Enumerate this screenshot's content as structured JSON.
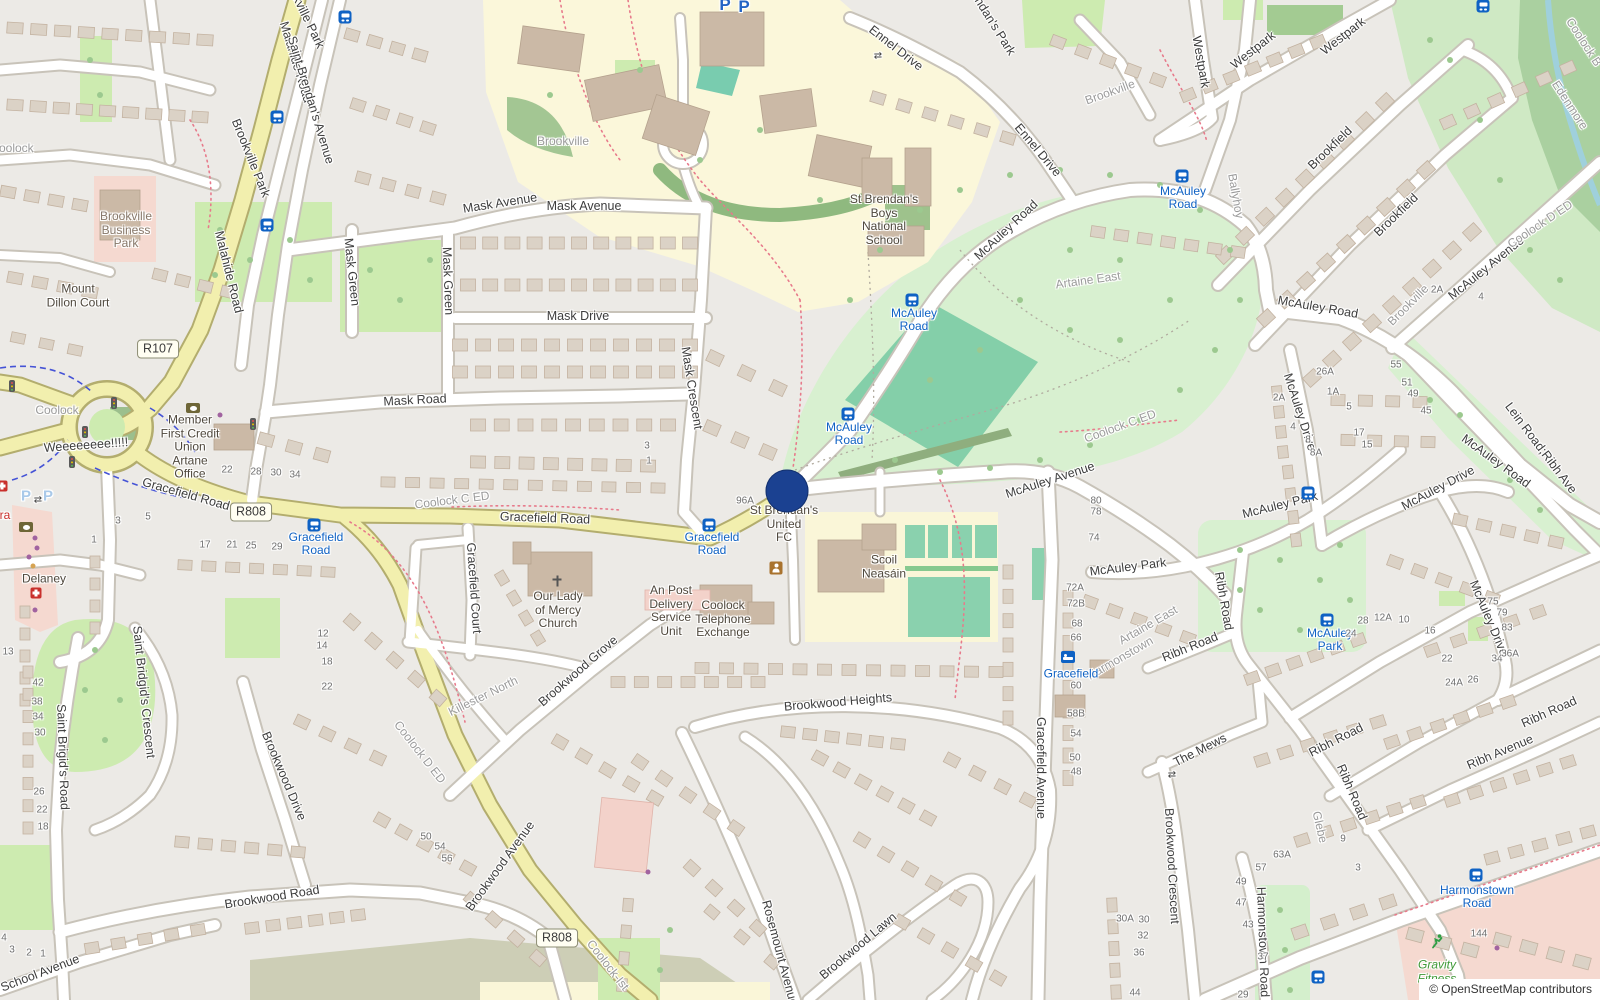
{
  "attribution": "© OpenStreetMap contributors",
  "map": {
    "marker": {
      "x": 787,
      "y": 491
    },
    "route_shields": [
      {
        "text": "R107",
        "x": 158,
        "y": 349
      },
      {
        "text": "R808",
        "x": 251,
        "y": 512
      },
      {
        "text": "R808",
        "x": 557,
        "y": 938
      }
    ],
    "street_labels": [
      [
        "Malahide Road",
        296,
        62,
        73
      ],
      [
        "Malahide Road",
        229,
        272,
        76
      ],
      [
        "Saint Brendan's Avenue",
        311,
        100,
        73
      ],
      [
        "Brookville Park",
        251,
        158,
        68
      ],
      [
        "Brookville Park",
        303,
        10,
        64
      ],
      [
        "Mask Avenue",
        500,
        203,
        -9
      ],
      [
        "Mask Avenue",
        584,
        206,
        0
      ],
      [
        "Mask Green",
        352,
        272,
        84
      ],
      [
        "Mask Green",
        448,
        281,
        88
      ],
      [
        "Mask Drive",
        578,
        316,
        0
      ],
      [
        "Mask Road",
        415,
        400,
        -3
      ],
      [
        "Mask Crescent",
        692,
        388,
        81
      ],
      [
        "Gracefield Road",
        186,
        494,
        16
      ],
      [
        "Gracefield Road",
        545,
        518,
        2
      ],
      [
        "Gracefield Court",
        474,
        588,
        86
      ],
      [
        "Gracefield Avenue",
        1041,
        768,
        90
      ],
      [
        "Ennel Drive",
        896,
        48,
        38
      ],
      [
        "Ennel Drive",
        1038,
        150,
        50
      ],
      [
        "Brendan's Park",
        990,
        18,
        58
      ],
      [
        "Westpark",
        1201,
        62,
        80
      ],
      [
        "Westpark",
        1253,
        50,
        -38
      ],
      [
        "Westpark",
        1343,
        36,
        -38
      ],
      [
        "Brookfield",
        1330,
        148,
        -44
      ],
      [
        "Brookfield",
        1396,
        215,
        -44
      ],
      [
        "McAuley Road",
        1006,
        230,
        -43
      ],
      [
        "McAuley Road",
        1318,
        307,
        10
      ],
      [
        "McAuley Road",
        1496,
        461,
        36
      ],
      [
        "McAuley Avenue",
        1050,
        480,
        -18
      ],
      [
        "McAuley Avenue",
        1486,
        268,
        -39
      ],
      [
        "McAuley Park",
        1128,
        567,
        -7
      ],
      [
        "McAuley Park",
        1280,
        505,
        -14
      ],
      [
        "McAuley Drive",
        1300,
        412,
        72
      ],
      [
        "McAuley Drive",
        1438,
        488,
        -28
      ],
      [
        "McAuley Drive",
        1489,
        618,
        67
      ],
      [
        "Lein Road;Ribh Ave",
        1541,
        448,
        53
      ],
      [
        "Ribh Avenue",
        1500,
        752,
        -23
      ],
      [
        "Ribh Road",
        1190,
        647,
        -22
      ],
      [
        "Ribh Road",
        1224,
        601,
        80
      ],
      [
        "Ribh Road",
        1336,
        740,
        -27
      ],
      [
        "Ribh Road",
        1352,
        792,
        67
      ],
      [
        "Ribh Road",
        1549,
        712,
        -24
      ],
      [
        "The Mews",
        1200,
        750,
        -27
      ],
      [
        "Brookwood Crescent",
        1172,
        866,
        87
      ],
      [
        "Brookwood Grove",
        578,
        671,
        -41
      ],
      [
        "Brookwood Heights",
        838,
        702,
        -5
      ],
      [
        "Brookwood Road",
        272,
        897,
        -9
      ],
      [
        "Brookwood Avenue",
        500,
        866,
        -54
      ],
      [
        "Brookwood Drive",
        284,
        776,
        67
      ],
      [
        "Brookwood Lawn",
        858,
        946,
        -40
      ],
      [
        "Rosemount Avenue",
        780,
        953,
        75
      ],
      [
        "Harmonstown Road",
        1263,
        942,
        88
      ],
      [
        "Saint Bridgid's Crescent",
        144,
        692,
        84
      ],
      [
        "Saint Brigid's Road",
        63,
        757,
        88
      ],
      [
        "School Avenue",
        40,
        973,
        -21
      ],
      [
        "Weeeeeeee!!!!!",
        86,
        445,
        -4
      ]
    ],
    "locality_labels": [
      [
        "Coolock",
        57,
        410,
        0
      ],
      [
        "Coolock",
        12,
        148,
        0
      ],
      [
        "Brookville",
        563,
        141,
        0
      ],
      [
        "Brookville",
        1110,
        92,
        -20
      ],
      [
        "Brookville",
        1408,
        305,
        -45
      ],
      [
        "Ballyhoy",
        1236,
        196,
        80
      ],
      [
        "Artaine East",
        1088,
        280,
        -8
      ],
      [
        "Artaine East",
        1148,
        625,
        -30
      ],
      [
        "Harmonstown",
        1120,
        658,
        -30
      ],
      [
        "Killester North",
        483,
        696,
        -26
      ],
      [
        "Edenmore",
        1570,
        105,
        57
      ],
      [
        "Coolock B",
        1584,
        42,
        57
      ],
      [
        "Glebe",
        1320,
        827,
        77
      ],
      [
        "Coolock D ED",
        1540,
        224,
        -34
      ],
      [
        "Coolock D ED",
        420,
        752,
        52
      ],
      [
        "Coolock C ED",
        1120,
        426,
        -20
      ],
      [
        "Coolock C ED",
        452,
        500,
        -7
      ],
      [
        "Coolock-Ist",
        608,
        965,
        52
      ]
    ],
    "poi_labels": [
      {
        "lines": [
          "Brookville",
          "Business",
          "Park"
        ],
        "x": 126,
        "y": 230,
        "style": "biz"
      },
      {
        "lines": [
          "Mount",
          "Dillon Court"
        ],
        "x": 78,
        "y": 296,
        "style": "poi"
      },
      {
        "lines": [
          "Member",
          "First Credit",
          "Union",
          "Artane",
          "Office"
        ],
        "x": 190,
        "y": 447,
        "style": "poi"
      },
      {
        "lines": [
          "Our Lady",
          "of Mercy",
          "Church"
        ],
        "x": 558,
        "y": 610,
        "style": "poi"
      },
      {
        "lines": [
          "An Post",
          "Delivery",
          "Service",
          "Unit"
        ],
        "x": 671,
        "y": 611,
        "style": "poi"
      },
      {
        "lines": [
          "Coolock",
          "Telephone",
          "Exchange"
        ],
        "x": 723,
        "y": 619,
        "style": "poi"
      },
      {
        "lines": [
          "St Brendan's",
          "Boys",
          "National",
          "School"
        ],
        "x": 884,
        "y": 220,
        "style": "poi"
      },
      {
        "lines": [
          "Scoil",
          "Neasáin"
        ],
        "x": 884,
        "y": 567,
        "style": "poi"
      },
      {
        "lines": [
          "St Brendan's",
          "United",
          "FC"
        ],
        "x": 784,
        "y": 524,
        "style": "poi"
      },
      {
        "lines": [
          "Delaney"
        ],
        "x": 44,
        "y": 579,
        "style": "poi"
      },
      {
        "lines": [
          "Gravity",
          "Fitness"
        ],
        "x": 1437,
        "y": 972,
        "style": "fitness"
      }
    ],
    "transit_stops": [
      {
        "lines": [
          "McAuley",
          "Road"
        ],
        "x": 1183,
        "y": 198,
        "ix": 1182,
        "iy": 176,
        "icon": "bus"
      },
      {
        "lines": [
          "McAuley",
          "Road"
        ],
        "x": 914,
        "y": 320,
        "ix": 912,
        "iy": 300,
        "icon": "bus"
      },
      {
        "lines": [
          "McAuley",
          "Road"
        ],
        "x": 849,
        "y": 434,
        "ix": 848,
        "iy": 414,
        "icon": "bus"
      },
      {
        "lines": [
          "McAuley",
          "Park"
        ],
        "x": 1330,
        "y": 640,
        "ix": 1327,
        "iy": 620,
        "icon": "bus"
      },
      {
        "lines": [
          "Gracefield",
          "Road"
        ],
        "x": 316,
        "y": 544,
        "ix": 314,
        "iy": 525,
        "icon": "bus"
      },
      {
        "lines": [
          "Gracefield",
          "Road"
        ],
        "x": 712,
        "y": 544,
        "ix": 709,
        "iy": 525,
        "icon": "bus"
      },
      {
        "lines": [
          "Harmonstown",
          "Road"
        ],
        "x": 1477,
        "y": 897,
        "ix": 1476,
        "iy": 875,
        "icon": "bus"
      },
      {
        "lines": [
          "Gracefield"
        ],
        "x": 1071,
        "y": 674,
        "ix": 1068,
        "iy": 657,
        "icon": "bed"
      }
    ],
    "transit_icons_only": [
      [
        1483,
        6
      ],
      [
        345,
        17
      ],
      [
        277,
        117
      ],
      [
        267,
        225
      ],
      [
        1308,
        493
      ],
      [
        1318,
        977
      ]
    ],
    "house_numbers": [
      [
        "22",
        227,
        470
      ],
      [
        "28",
        256,
        472
      ],
      [
        "30",
        276,
        473
      ],
      [
        "34",
        295,
        475
      ],
      [
        "1",
        94,
        540
      ],
      [
        "3",
        118,
        521
      ],
      [
        "5",
        148,
        517
      ],
      [
        "17",
        205,
        545
      ],
      [
        "21",
        232,
        545
      ],
      [
        "25",
        251,
        546
      ],
      [
        "29",
        277,
        547
      ],
      [
        "3",
        647,
        446
      ],
      [
        "1",
        649,
        461
      ],
      [
        "96A",
        745,
        501
      ],
      [
        "13",
        8,
        652
      ],
      [
        "42",
        38,
        683
      ],
      [
        "38",
        37,
        702
      ],
      [
        "34",
        38,
        717
      ],
      [
        "30",
        40,
        733
      ],
      [
        "26",
        39,
        792
      ],
      [
        "22",
        42,
        810
      ],
      [
        "18",
        43,
        827
      ],
      [
        "12",
        323,
        634
      ],
      [
        "14",
        322,
        646
      ],
      [
        "18",
        327,
        662
      ],
      [
        "22",
        327,
        687
      ],
      [
        "4",
        4,
        938
      ],
      [
        "3",
        12,
        950
      ],
      [
        "2",
        29,
        953
      ],
      [
        "1",
        43,
        954
      ],
      [
        "50",
        426,
        837
      ],
      [
        "54",
        440,
        847
      ],
      [
        "56",
        447,
        859
      ],
      [
        "72A",
        1075,
        588
      ],
      [
        "72B",
        1076,
        604
      ],
      [
        "68",
        1077,
        624
      ],
      [
        "66",
        1076,
        638
      ],
      [
        "60",
        1076,
        686
      ],
      [
        "58B",
        1076,
        714
      ],
      [
        "54",
        1076,
        734
      ],
      [
        "50",
        1075,
        758
      ],
      [
        "48",
        1076,
        772
      ],
      [
        "30A",
        1125,
        919
      ],
      [
        "30",
        1144,
        920
      ],
      [
        "32",
        1143,
        936
      ],
      [
        "36",
        1139,
        953
      ],
      [
        "44",
        1135,
        993
      ],
      [
        "28",
        1363,
        621
      ],
      [
        "12A",
        1383,
        618
      ],
      [
        "10",
        1404,
        620
      ],
      [
        "24",
        1351,
        634
      ],
      [
        "16",
        1430,
        631
      ],
      [
        "22",
        1447,
        659
      ],
      [
        "24A",
        1454,
        683
      ],
      [
        "26",
        1473,
        680
      ],
      [
        "34",
        1497,
        659
      ],
      [
        "36A",
        1510,
        654
      ],
      [
        "75",
        1493,
        602
      ],
      [
        "79",
        1502,
        613
      ],
      [
        "83",
        1507,
        628
      ],
      [
        "63A",
        1282,
        855
      ],
      [
        "57",
        1261,
        868
      ],
      [
        "49",
        1241,
        882
      ],
      [
        "47",
        1241,
        903
      ],
      [
        "43",
        1248,
        925
      ],
      [
        "37",
        1263,
        957
      ],
      [
        "29",
        1243,
        995
      ],
      [
        "9",
        1343,
        839
      ],
      [
        "3",
        1358,
        868
      ],
      [
        "144",
        1479,
        934
      ],
      [
        "26A",
        1325,
        372
      ],
      [
        "1A",
        1333,
        392
      ],
      [
        "5",
        1349,
        407
      ],
      [
        "17",
        1359,
        433
      ],
      [
        "15",
        1367,
        445
      ],
      [
        "55",
        1396,
        365
      ],
      [
        "51",
        1407,
        383
      ],
      [
        "49",
        1413,
        394
      ],
      [
        "45",
        1426,
        411
      ],
      [
        "2A",
        1279,
        398
      ],
      [
        "4",
        1293,
        427
      ],
      [
        "8",
        1308,
        440
      ],
      [
        "8A",
        1316,
        453
      ],
      [
        "80",
        1096,
        501
      ],
      [
        "78",
        1096,
        512
      ],
      [
        "74",
        1094,
        538
      ],
      [
        "2A",
        1437,
        290
      ],
      [
        "4",
        1481,
        297
      ]
    ],
    "parking": {
      "glyph": "P",
      "large": [
        [
          725,
          5
        ],
        [
          744,
          7
        ]
      ],
      "small": [
        [
          26,
          496
        ],
        [
          48,
          496
        ]
      ]
    },
    "retail_fragment": {
      "text": "ra",
      "x": 5,
      "y": 515
    },
    "misc_icons": [
      {
        "type": "traffic-light",
        "x": 85,
        "y": 432
      },
      {
        "type": "traffic-light",
        "x": 114,
        "y": 403
      },
      {
        "type": "traffic-light",
        "x": 72,
        "y": 462
      },
      {
        "type": "traffic-light",
        "x": 12,
        "y": 386
      },
      {
        "type": "traffic-light",
        "x": 253,
        "y": 424
      },
      {
        "type": "gate",
        "glyph": "⇄",
        "x": 878,
        "y": 56
      },
      {
        "type": "gate",
        "glyph": "⇄",
        "x": 38,
        "y": 500
      },
      {
        "type": "gate",
        "glyph": "⇄",
        "x": 1172,
        "y": 775
      },
      {
        "type": "pharmacy",
        "x": 36,
        "y": 593
      },
      {
        "type": "clinic",
        "x": 2,
        "y": 486
      },
      {
        "type": "bank",
        "x": 193,
        "y": 408
      },
      {
        "type": "bank",
        "x": 26,
        "y": 527
      },
      {
        "type": "shop-dot",
        "x": 35,
        "y": 538
      },
      {
        "type": "shop-dot",
        "x": 37,
        "y": 548
      },
      {
        "type": "shop-dot",
        "x": 29,
        "y": 557
      },
      {
        "type": "shop-dot",
        "x": 35,
        "y": 610
      },
      {
        "type": "shop-dot",
        "x": 648,
        "y": 872
      },
      {
        "type": "shop-dot",
        "x": 1497,
        "y": 948
      },
      {
        "type": "shop-dot",
        "x": 220,
        "y": 415
      },
      {
        "type": "shop-dot-food",
        "x": 33,
        "y": 566
      },
      {
        "type": "community-centre",
        "x": 776,
        "y": 568
      },
      {
        "type": "fitness-runner",
        "x": 1437,
        "y": 944
      },
      {
        "type": "church-cross",
        "x": 557,
        "y": 581
      }
    ]
  }
}
